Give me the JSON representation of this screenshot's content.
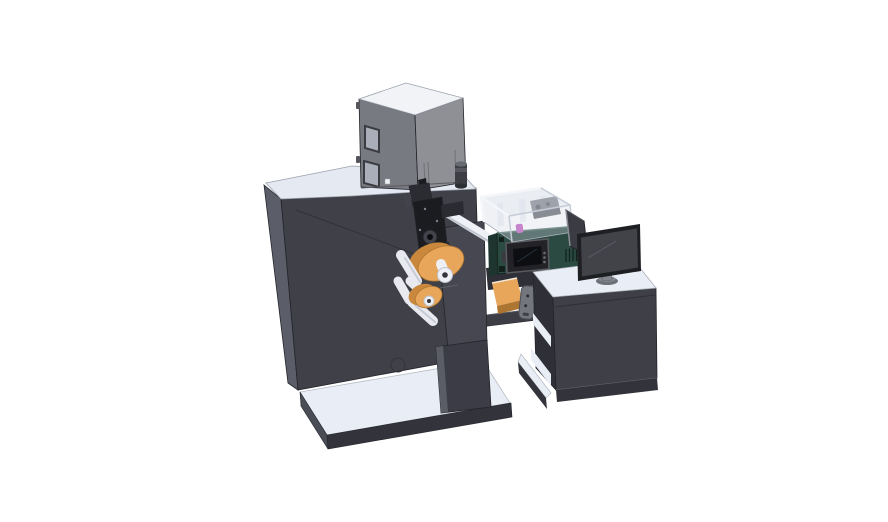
{
  "scene": {
    "type": "3d-cad-render",
    "description": "Isometric CAD rendering of an industrial label printing and inspection machine line with an operator desk and monitor on a white background",
    "background": "#ffffff",
    "components": [
      {
        "name": "base-platform",
        "label": "white base platform of main machine"
      },
      {
        "name": "machine-body",
        "label": "dark main machine cabinet"
      },
      {
        "name": "electrical-cabinet",
        "label": "gray electrical cabinet on machine top"
      },
      {
        "name": "exhaust-cylinder",
        "label": "small dark cylinder on machine top"
      },
      {
        "name": "mounting-plate",
        "label": "front mounting plate and support column"
      },
      {
        "name": "print-mechanism",
        "label": "black print head mechanism"
      },
      {
        "name": "label-roll-upper",
        "label": "upper orange label roll with white core"
      },
      {
        "name": "label-roll-lower",
        "label": "lower orange label roll with white core"
      },
      {
        "name": "guide-rollers",
        "label": "white guide rollers"
      },
      {
        "name": "output-chute",
        "label": "orange output chute"
      },
      {
        "name": "sensor-module",
        "label": "gray sensor module"
      },
      {
        "name": "support-arm",
        "label": "support arm bridging machine to desk"
      },
      {
        "name": "inspection-unit",
        "label": "dark teal inspection unit with touchscreen panel"
      },
      {
        "name": "clear-enclosure",
        "label": "transparent safety enclosure with inner rollers and magenta part"
      },
      {
        "name": "operator-desk",
        "label": "operator desk cabinet with open side shelf"
      },
      {
        "name": "desk-monitor",
        "label": "desktop monitor on oval stand"
      },
      {
        "name": "side-panel",
        "label": "angled side panel behind monitor"
      }
    ],
    "colors": {
      "bg": "#ffffff",
      "surfaceTop": "#e9edf5",
      "surfaceBright": "#f3f5fa",
      "machineFront": "#3f4048",
      "machineSide": "#5b5d68",
      "machineTop": "#e4e9f2",
      "skirtDark": "#33343b",
      "baseSide": "#4a4c56",
      "plate": "#464751",
      "column": "#3b3c45",
      "columnEdge": "#5a5c66",
      "grayboxTop": "#f2f3f6",
      "grayboxFront": "#8f9096",
      "grayboxSide": "#787a81",
      "windowFrame": "#3b3c42",
      "windowFill": "#a9aeb9",
      "cylDark": "#3d3e44",
      "cylLight": "#686a71",
      "mechBlack": "#1b1c20",
      "mechDark": "#2b2c32",
      "mechMid": "#43444b",
      "chrome": "#eff1f6",
      "chromeShade": "#c0c5cf",
      "roller": "#e8eaf0",
      "rollerShade": "#c6cbd5",
      "orange": "#e7a65a",
      "orangeSide": "#c9883c",
      "orangeDeep": "#ad7532",
      "coreWhite": "#eef0f5",
      "greenFront": "#2b4a41",
      "greenSide": "#1d352e",
      "greenDark": "#12211c",
      "screenBlack": "#0d0e11",
      "screenRim": "#232327",
      "rimLight": "#5a5b61",
      "glass": "#d5dbe6",
      "glassFrame": "#f4f6fa",
      "glassEdge": "#99a0ac",
      "magenta": "#c05ec2",
      "sensor": "#74767e",
      "sensorEdge": "#4e4f56",
      "deskFront": "#3e3f47",
      "deskSide": "#2e2f37",
      "monitorBezel": "#1e1f23",
      "monitorScreen": "#414349",
      "standGray": "#84868d",
      "standBase": "#6e7077",
      "panelBack": "#3b3c43",
      "lineDark": "#24252b",
      "highlight": "#8c8f97",
      "innerDark": "#4d4e56"
    }
  }
}
